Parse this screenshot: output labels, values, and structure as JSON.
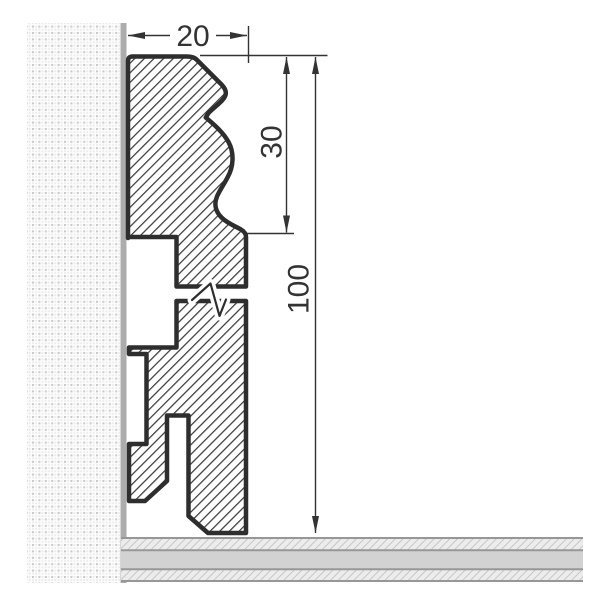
{
  "drawing": {
    "dimension_labels": {
      "width": "20",
      "upper_height": "30",
      "total_height": "100"
    },
    "colors": {
      "outline": "#2e2e2e",
      "hatch_line": "#3c3c3c",
      "dimension": "#333333",
      "wall_edge": "#acacac",
      "wall_dot": "#c9c9c9",
      "wall_dot_faint": "#eaeaea",
      "floor_core": "#d2d2d2",
      "floor_hatch_bg": "#ececec",
      "floor_hatch_line": "#c6c6c6",
      "floor_border": "#979797",
      "background": "#ffffff"
    }
  }
}
